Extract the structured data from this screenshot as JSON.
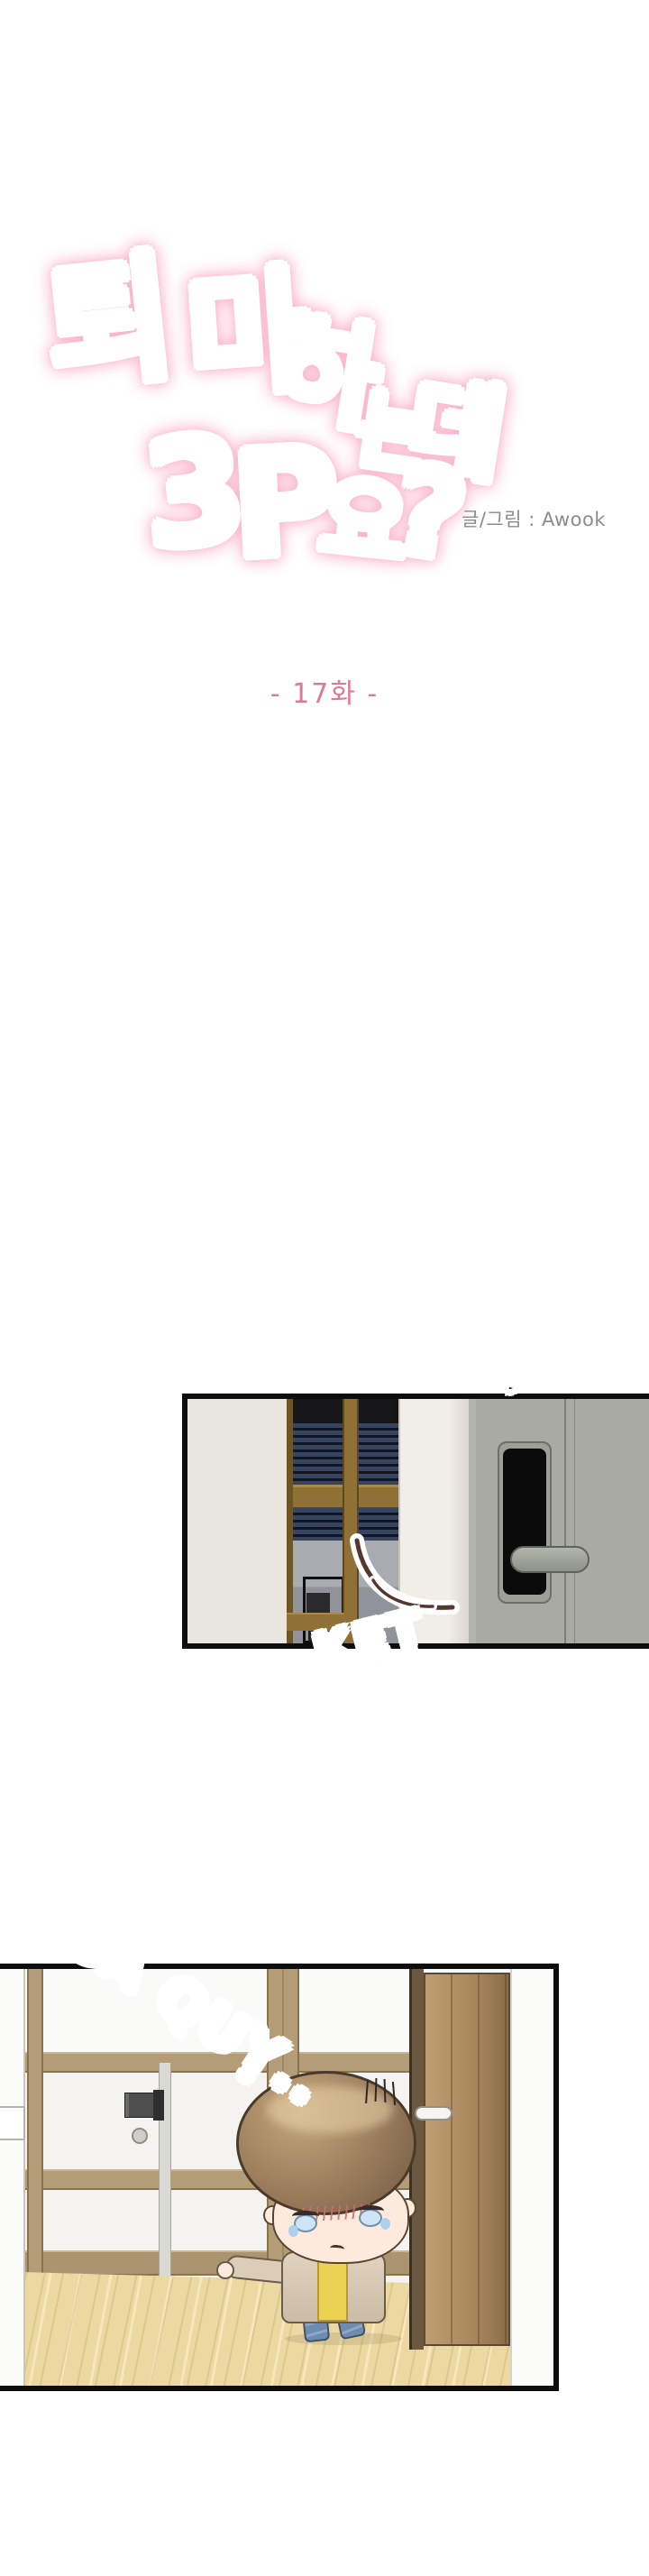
{
  "title": {
    "chars": [
      "퇴",
      "마",
      "하",
      "는",
      "데",
      "3",
      "P",
      "요",
      "?"
    ],
    "full_title": "퇴마하는데 3P요?",
    "credit": "글/그림 : Awook",
    "colors": {
      "pink": "#ee6f9e",
      "orange": "#ee8a64",
      "gold": "#f3ce96",
      "glow": "#faadc8"
    }
  },
  "episode": {
    "label": "- 17화 -",
    "color": "#e0798f"
  },
  "panel1": {
    "description": "close-up of a grey sliding door with black digital keypad lock and lever handle, dark room with navy blinds and gold window frame visible through opening at left",
    "sfx_top": "CẠCH",
    "sfx_bottom": "KẸT",
    "colors": {
      "door": "#a9aba2",
      "lock_panel": "#0b0b0c",
      "wall": "#e9e6e0",
      "frame_gold": "#8f7136",
      "blinds": "#37435f",
      "sfx_top_color": "#8d4a36",
      "sfx_bottom_color": "#b5593f"
    }
  },
  "panel2": {
    "description": "hallway with tan-framed glass sliding doors, wood floor, open brown door at right, teary chibi boy in beige coat, yellow shirt and jeans slumping against the doorway",
    "sfx": "NGÃ QUỴ..",
    "colors": {
      "beam": "#b49d76",
      "floor": "#ecd9a2",
      "open_door": "#a8865c",
      "hair": "#97795a",
      "coat": "#d9cbb6",
      "shirt": "#ecd253",
      "jeans": "#6f8bb0",
      "sfx_color": "#ad8b3e"
    }
  }
}
